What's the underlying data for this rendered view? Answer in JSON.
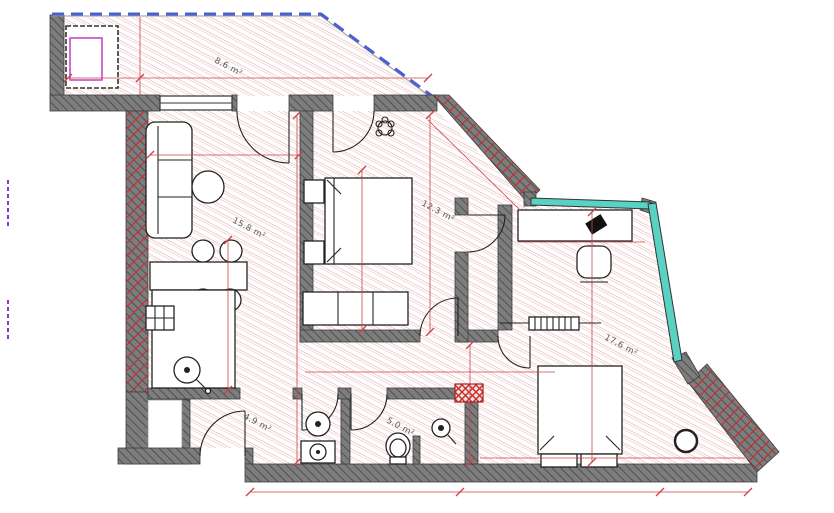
{
  "plan": {
    "title": "apartment-floor-plan",
    "rooms": [
      {
        "id": "balcony",
        "label": "8.6 m²"
      },
      {
        "id": "living-kitchen",
        "label": "15.8 m²"
      },
      {
        "id": "bedroom",
        "label": "12.3 m²"
      },
      {
        "id": "office-bedroom",
        "label": "17.6 m²"
      },
      {
        "id": "hallway",
        "label": "4.9 m²"
      },
      {
        "id": "bathroom",
        "label": "5.0 m²"
      }
    ],
    "colors": {
      "floor_hatch": "#e29a9a",
      "wall_fill": "#7d7d7d",
      "wall_hatch": "#454545",
      "exterior_red_hatch": "#cc2b2b",
      "dimension_red": "#cc4444",
      "boundary_blue": "#4a5fd0",
      "window_cyan": "#5ad2c3",
      "fixture_magenta": "#c43fc4",
      "label_color": "#4a5e57"
    }
  }
}
